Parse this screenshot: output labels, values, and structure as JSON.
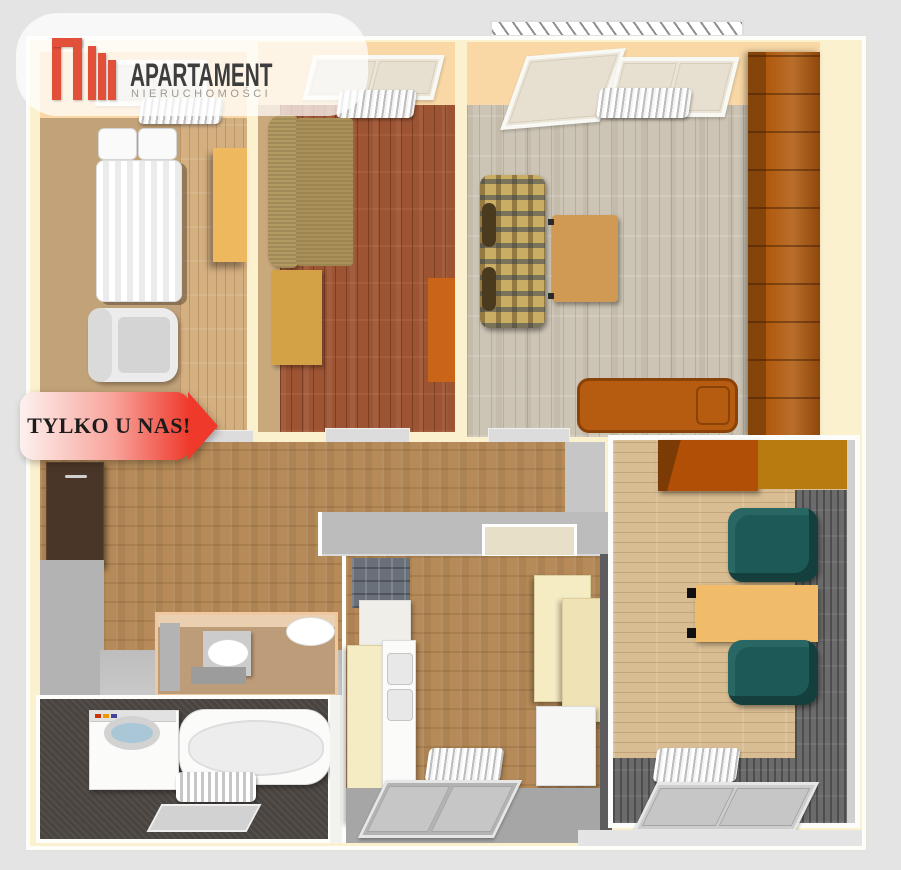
{
  "page": {
    "background": "#e4e4e4"
  },
  "logo": {
    "title": "APARTAMENT",
    "subtitle": "NIERUCHOMOŚCI",
    "mark_color": "#e2503a",
    "title_color": "#3d3d3d",
    "subtitle_color": "#9b9b9b"
  },
  "badge": {
    "label": "TYLKO U NAS!",
    "text_color": "#1c1c1c",
    "gradient": [
      "#fdf1ef",
      "#ee392b"
    ]
  },
  "floorplan": {
    "walls": {
      "outer_cream": "#fbf1cf",
      "accent_peach": "#f9d8a6",
      "interior_white": "#fdfdf9",
      "interior_gray": "#b5b5b5"
    },
    "rooms": [
      {
        "id": "bedroom",
        "position": "top-left",
        "floor_colors": [
          "#c2a278",
          "#d4af80"
        ],
        "items": [
          "double-bed",
          "armchair",
          "desk",
          "radiator",
          "window"
        ]
      },
      {
        "id": "lounge-small",
        "position": "top-middle",
        "floor_colors": [
          "#9d5433"
        ],
        "items": [
          "sofa",
          "cabinet",
          "rug",
          "radiator",
          "window"
        ]
      },
      {
        "id": "living-room",
        "position": "top-right",
        "floor_colors": [
          "#ccc4b4"
        ],
        "items": [
          "plaid-sofa",
          "coffee-table",
          "daybed",
          "wardrobe",
          "radiator",
          "windows",
          "balcony"
        ]
      },
      {
        "id": "hallway",
        "position": "center-left",
        "floor_colors": [
          "#b68b59"
        ],
        "items": [
          "wardrobe",
          "pass-through-counter"
        ]
      },
      {
        "id": "wc",
        "position": "center",
        "floor_colors": [
          "#bd9c79"
        ],
        "items": [
          "washbasin",
          "toilet"
        ]
      },
      {
        "id": "bathroom",
        "position": "bottom-left",
        "floor_colors": [
          "#4a4440"
        ],
        "items": [
          "washing-machine",
          "bathtub",
          "bath-mat",
          "rug"
        ]
      },
      {
        "id": "kitchen",
        "position": "bottom-middle",
        "floor_colors": [
          "#b68b59"
        ],
        "items": [
          "cabinets",
          "sink",
          "splashback-tiles",
          "radiator",
          "window"
        ]
      },
      {
        "id": "study",
        "position": "bottom-right",
        "floor_colors": [
          "#d9bd92",
          "#6b6b6b"
        ],
        "items": [
          "cabinets",
          "two-armchairs",
          "desk",
          "radiator",
          "window"
        ]
      }
    ]
  }
}
